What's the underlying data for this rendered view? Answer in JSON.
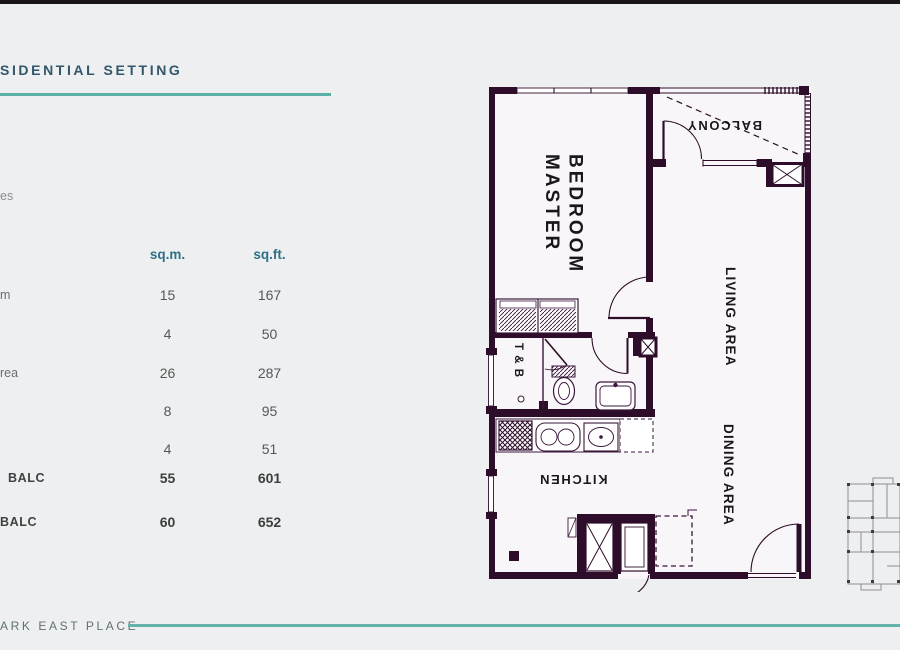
{
  "page": {
    "title_fragment": "SIDENTIAL SETTING",
    "side_text_fragment": "es",
    "footer_brand_fragment": "ARK EAST PLACE"
  },
  "area_table": {
    "col_headers": {
      "sqm": "sq.m.",
      "sqft": "sq.ft."
    },
    "rows": [
      {
        "label_fragment": "m",
        "sqm": "15",
        "sqft": "167",
        "emphasis": false
      },
      {
        "label_fragment": "",
        "sqm": "4",
        "sqft": "50",
        "emphasis": false
      },
      {
        "label_fragment": "rea",
        "sqm": "26",
        "sqft": "287",
        "emphasis": false
      },
      {
        "label_fragment": "",
        "sqm": "8",
        "sqft": "95",
        "emphasis": false
      },
      {
        "label_fragment": "",
        "sqm": "4",
        "sqft": "51",
        "emphasis": false
      },
      {
        "label_fragment": "BALC",
        "sqm": "55",
        "sqft": "601",
        "emphasis": true
      },
      {
        "label_fragment": "BALC",
        "sqm": "60",
        "sqft": "652",
        "emphasis": true
      }
    ]
  },
  "floorplan": {
    "labels": {
      "master_bedroom": "MASTER\nBEDROOM",
      "balcony": "BALCONY",
      "living_area": "LIVING AREA",
      "dining_area": "DINING AREA",
      "toilet_bath": "T & B",
      "kitchen": "KITCHEN"
    }
  },
  "colors": {
    "slide_background": "#edeff0",
    "top_bar": "#17141a",
    "heading_text": "#32566b",
    "accent_teal": "#5cb1a7",
    "table_header": "#2f7089",
    "table_value": "#575757",
    "plan_wall": "#2d0d2a",
    "plan_thin_line": "#3a173a",
    "plan_paper": "#f9f6f9",
    "keyplan_line": "#8e8e98"
  }
}
